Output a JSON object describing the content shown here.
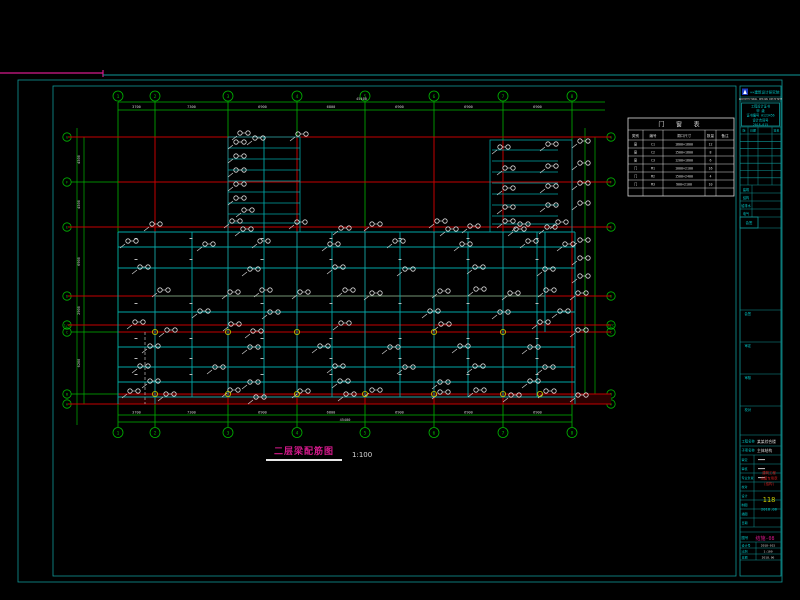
{
  "colors": {
    "grid_green": "#00b400",
    "axis_red": "#c30000",
    "beam_teal": "#00a6a6",
    "frame_teal": "#0e9898",
    "callout_white": "#dcdcdc",
    "dim_white": "#cfcfcf",
    "magenta": "#d6198c",
    "yellow": "#c8c800",
    "cyan_text": "#00c8c8",
    "gray": "#9a9a9a",
    "logo_blue": "#1d3bc0",
    "maroon_band": "#2a0000",
    "stamp_red": "#d22020"
  },
  "drawing_title": {
    "text": "二层梁配筋图",
    "scale": "1:100"
  },
  "drawing": {
    "axes_vertical": [
      {
        "label": "1",
        "x": 118
      },
      {
        "label": "2",
        "x": 155
      },
      {
        "label": "3",
        "x": 228
      },
      {
        "label": "4",
        "x": 297
      },
      {
        "label": "5",
        "x": 365
      },
      {
        "label": "6",
        "x": 434
      },
      {
        "label": "7",
        "x": 503
      },
      {
        "label": "8",
        "x": 572
      }
    ],
    "axes_horizontal": [
      {
        "label": "G",
        "y": 137
      },
      {
        "label": "F",
        "y": 182
      },
      {
        "label": "E",
        "y": 227
      },
      {
        "label": "D",
        "y": 296
      },
      {
        "label": "1/C",
        "y": 325
      },
      {
        "label": "C",
        "y": 332
      },
      {
        "label": "B",
        "y": 394
      },
      {
        "label": "A",
        "y": 404
      }
    ],
    "top_dims": [
      "3700",
      "7300",
      "6900",
      "6800",
      "6900",
      "6900",
      "6900"
    ],
    "top_total": "45400",
    "bottom_dims": [
      "3700",
      "7300",
      "6900",
      "6800",
      "6900",
      "6900",
      "6900"
    ],
    "bottom_total": "45400",
    "left_dims": [
      "4500",
      "4500",
      "6900",
      "2900",
      "700",
      "6200",
      "1000"
    ],
    "green_v_extra": [
      [
        77,
        128,
        425
      ],
      [
        84,
        137,
        404
      ],
      [
        585,
        128,
        404
      ],
      [
        595,
        137,
        404
      ]
    ],
    "dim_lines": [
      [
        102,
        118,
        605
      ],
      [
        110,
        118,
        605
      ],
      [
        415,
        118,
        572
      ],
      [
        422,
        118,
        572
      ]
    ],
    "beams_h": [
      [
        232,
        118,
        575
      ],
      [
        247,
        118,
        575
      ],
      [
        268,
        118,
        575
      ],
      [
        312,
        118,
        575
      ],
      [
        347,
        118,
        575
      ],
      [
        367,
        118,
        575
      ],
      [
        382,
        118,
        575
      ],
      [
        397,
        118,
        575
      ]
    ],
    "beams_v": [
      [
        118,
        232,
        404
      ],
      [
        155,
        232,
        404
      ],
      [
        192,
        232,
        397
      ],
      [
        228,
        232,
        397
      ],
      [
        264,
        137,
        232
      ],
      [
        264,
        232,
        397
      ],
      [
        297,
        232,
        397
      ],
      [
        332,
        232,
        397
      ],
      [
        365,
        232,
        397
      ],
      [
        400,
        232,
        397
      ],
      [
        434,
        232,
        397
      ],
      [
        468,
        232,
        397
      ],
      [
        503,
        232,
        397
      ],
      [
        537,
        232,
        397
      ],
      [
        545,
        232,
        332
      ],
      [
        575,
        232,
        404
      ]
    ],
    "core_a": {
      "x1": 228,
      "x2": 300,
      "y1": 137,
      "y2": 232,
      "rungs": [
        148,
        159,
        170,
        181,
        192,
        203,
        214,
        223
      ]
    },
    "core_b": {
      "x1": 490,
      "x2": 572,
      "y1": 140,
      "y2": 232,
      "rung_x1": 492,
      "rung_x2": 558,
      "rungs": [
        150,
        161,
        172,
        183,
        194,
        205,
        216,
        224
      ]
    },
    "red_h": [
      [
        137,
        68,
        611
      ],
      [
        182,
        118,
        611
      ],
      [
        227,
        68,
        611
      ],
      [
        296,
        68,
        155
      ],
      [
        296,
        545,
        611
      ],
      [
        325,
        68,
        611
      ],
      [
        332,
        118,
        611
      ],
      [
        394,
        118,
        611
      ],
      [
        404,
        68,
        611
      ]
    ],
    "gray_h": [
      [
        296,
        155,
        545
      ]
    ],
    "red_v": [
      [
        155,
        137,
        404
      ],
      [
        228,
        137,
        404
      ],
      [
        297,
        137,
        404
      ],
      [
        365,
        227,
        404
      ],
      [
        434,
        137,
        404
      ],
      [
        503,
        140,
        404
      ],
      [
        572,
        140,
        404
      ]
    ],
    "dashed_white_v": [
      [
        145,
        332,
        404
      ]
    ],
    "band": [
      118,
      394,
      493,
      10
    ],
    "yellow_nodes": [
      [
        155,
        332
      ],
      [
        228,
        332
      ],
      [
        297,
        332
      ],
      [
        434,
        332
      ],
      [
        503,
        332
      ],
      [
        155,
        394
      ],
      [
        228,
        394
      ],
      [
        297,
        394
      ],
      [
        365,
        394
      ],
      [
        434,
        394
      ],
      [
        503,
        394
      ],
      [
        540,
        394
      ]
    ],
    "speck_rows": [
      240,
      261,
      305,
      340,
      360,
      376
    ],
    "speck_xs": [
      136,
      191,
      262,
      331,
      400,
      468,
      537
    ],
    "callouts": [
      [
        152,
        224
      ],
      [
        232,
        221
      ],
      [
        243,
        229
      ],
      [
        297,
        222
      ],
      [
        341,
        228
      ],
      [
        372,
        224
      ],
      [
        437,
        221
      ],
      [
        448,
        229
      ],
      [
        470,
        226
      ],
      [
        505,
        221
      ],
      [
        516,
        229
      ],
      [
        547,
        227
      ],
      [
        128,
        241
      ],
      [
        205,
        244
      ],
      [
        260,
        241
      ],
      [
        330,
        244
      ],
      [
        395,
        241
      ],
      [
        462,
        244
      ],
      [
        528,
        241
      ],
      [
        565,
        244
      ],
      [
        140,
        267
      ],
      [
        250,
        269
      ],
      [
        335,
        267
      ],
      [
        405,
        269
      ],
      [
        475,
        267
      ],
      [
        545,
        269
      ],
      [
        160,
        290
      ],
      [
        230,
        292
      ],
      [
        262,
        290
      ],
      [
        300,
        292
      ],
      [
        345,
        290
      ],
      [
        372,
        293
      ],
      [
        440,
        291
      ],
      [
        476,
        289
      ],
      [
        510,
        293
      ],
      [
        546,
        290
      ],
      [
        578,
        293
      ],
      [
        200,
        311
      ],
      [
        270,
        312
      ],
      [
        430,
        311
      ],
      [
        500,
        312
      ],
      [
        560,
        311
      ],
      [
        135,
        322
      ],
      [
        167,
        330
      ],
      [
        231,
        324
      ],
      [
        253,
        331
      ],
      [
        341,
        323
      ],
      [
        441,
        324
      ],
      [
        540,
        322
      ],
      [
        578,
        330
      ],
      [
        150,
        346
      ],
      [
        250,
        347
      ],
      [
        320,
        346
      ],
      [
        390,
        347
      ],
      [
        460,
        346
      ],
      [
        530,
        347
      ],
      [
        140,
        366
      ],
      [
        215,
        367
      ],
      [
        335,
        366
      ],
      [
        405,
        367
      ],
      [
        475,
        366
      ],
      [
        545,
        367
      ],
      [
        150,
        381
      ],
      [
        250,
        382
      ],
      [
        340,
        381
      ],
      [
        440,
        382
      ],
      [
        530,
        381
      ],
      [
        130,
        391
      ],
      [
        166,
        394
      ],
      [
        230,
        390
      ],
      [
        256,
        397
      ],
      [
        300,
        391
      ],
      [
        346,
        394
      ],
      [
        372,
        390
      ],
      [
        440,
        392
      ],
      [
        476,
        390
      ],
      [
        511,
        395
      ],
      [
        546,
        391
      ],
      [
        578,
        395
      ],
      [
        236,
        142
      ],
      [
        236,
        156
      ],
      [
        236,
        170
      ],
      [
        236,
        184
      ],
      [
        236,
        198
      ],
      [
        244,
        210
      ],
      [
        240,
        133
      ],
      [
        298,
        134
      ],
      [
        255,
        138
      ],
      [
        500,
        147
      ],
      [
        548,
        144
      ],
      [
        580,
        141
      ],
      [
        505,
        168
      ],
      [
        548,
        166
      ],
      [
        580,
        163
      ],
      [
        505,
        188
      ],
      [
        548,
        186
      ],
      [
        580,
        183
      ],
      [
        505,
        207
      ],
      [
        548,
        205
      ],
      [
        580,
        203
      ],
      [
        520,
        224
      ],
      [
        558,
        222
      ],
      [
        580,
        240
      ],
      [
        580,
        258
      ],
      [
        580,
        276
      ]
    ]
  },
  "schedule": {
    "x": 628,
    "y": 118,
    "title": "门 窗 表",
    "headers": [
      "类别",
      "编号",
      "洞口尺寸",
      "数量",
      "备注"
    ],
    "col_w": [
      15,
      20,
      42,
      11,
      18
    ],
    "title_h": 12,
    "header_h": 10,
    "row_h": 8,
    "rows": [
      [
        "窗",
        "C1",
        "1800×1800",
        "12",
        ""
      ],
      [
        "窗",
        "C2",
        "1500×1800",
        "8",
        ""
      ],
      [
        "窗",
        "C3",
        "1200×1800",
        "6",
        ""
      ],
      [
        "门",
        "M1",
        "1000×2100",
        "16",
        ""
      ],
      [
        "门",
        "M2",
        "1500×2400",
        "4",
        ""
      ],
      [
        "门",
        "M3",
        "900×2100",
        "10",
        ""
      ],
      [
        "",
        "",
        "",
        "",
        ""
      ]
    ]
  },
  "titleblock": {
    "company": "××建筑设计研究院",
    "company_sub": "ARCHITECTURAL DESIGN INSTITUTE",
    "cert_lines": [
      "工程设计证书",
      "甲 级",
      "证书编号 A123456",
      "设计合同号",
      "2018-015"
    ],
    "revision_headers": [
      "版",
      "日期",
      "签名"
    ],
    "sign_rows": [
      "建筑",
      "结构",
      "给排水",
      "电气"
    ],
    "sign_box": "会签",
    "approve_boxes": [
      "会签",
      "审定",
      "审核",
      "校对"
    ],
    "project_label": "工程名称",
    "project_value": "某某综合楼",
    "item_label": "子项名称",
    "item_value": "主体结构",
    "staff_rows": [
      "审定",
      "审核",
      "专业负责",
      "校对",
      "设计",
      "制图",
      "描图",
      "日期"
    ],
    "stamp_lines": [
      "建筑工程",
      "出图专用章",
      "(结构)"
    ],
    "stamp_number": "118",
    "stamp_date": "2018.06",
    "figno_label": "图号",
    "figno_value": "结施-08",
    "bottom_rows": [
      [
        "设计号",
        "2018-015"
      ],
      [
        "比例",
        "1:100"
      ],
      [
        "日期",
        "2018.06"
      ]
    ]
  }
}
